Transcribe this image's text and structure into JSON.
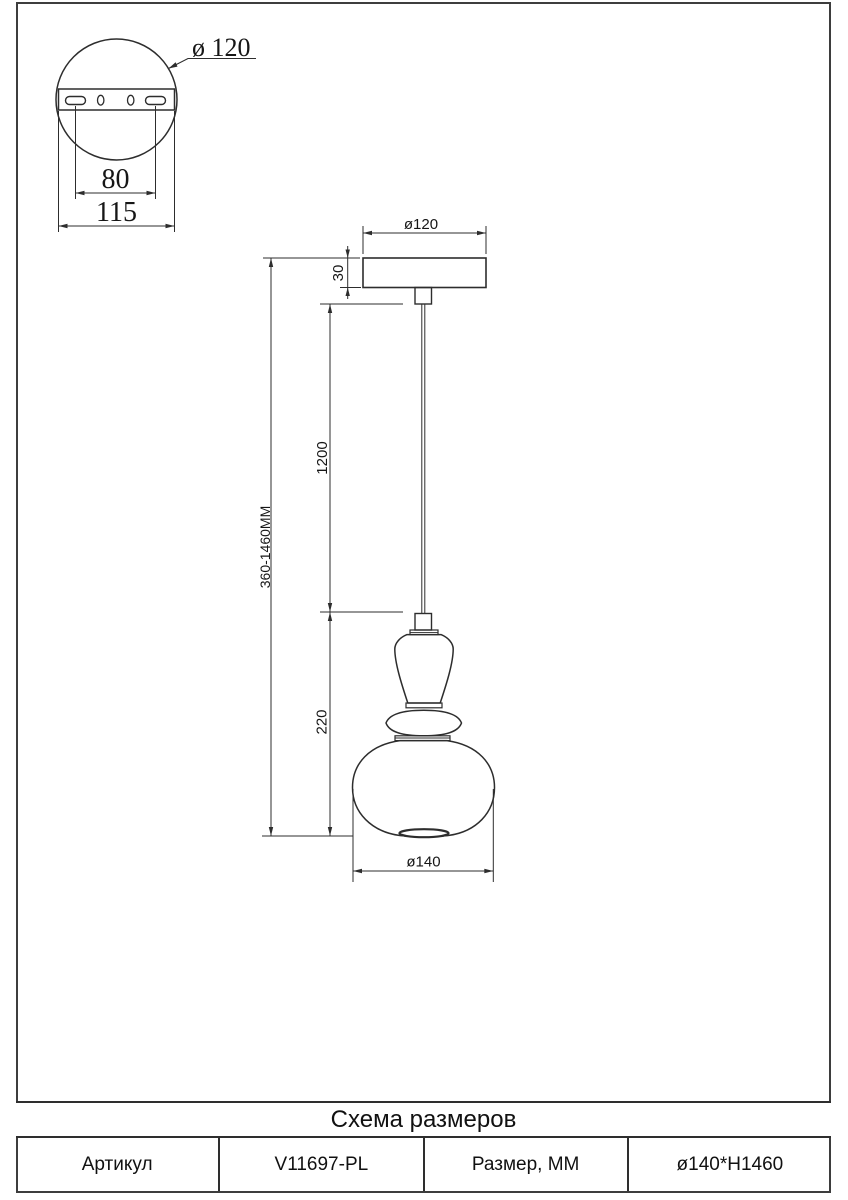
{
  "detail_view": {
    "diameter_label": "ø 120",
    "hole_spacing": "80",
    "plate_width": "115"
  },
  "main_view": {
    "canopy_diameter": "ø120",
    "canopy_height": "30",
    "cord_length": "1200",
    "overall_height": "360-1460MM",
    "shade_height": "220",
    "shade_diameter": "ø140"
  },
  "title_block": {
    "title": "Схема размеров",
    "article_label": "Артикул",
    "article_value": "V11697-PL",
    "size_label": "Размер, ММ",
    "size_value": "ø140*H1460"
  }
}
